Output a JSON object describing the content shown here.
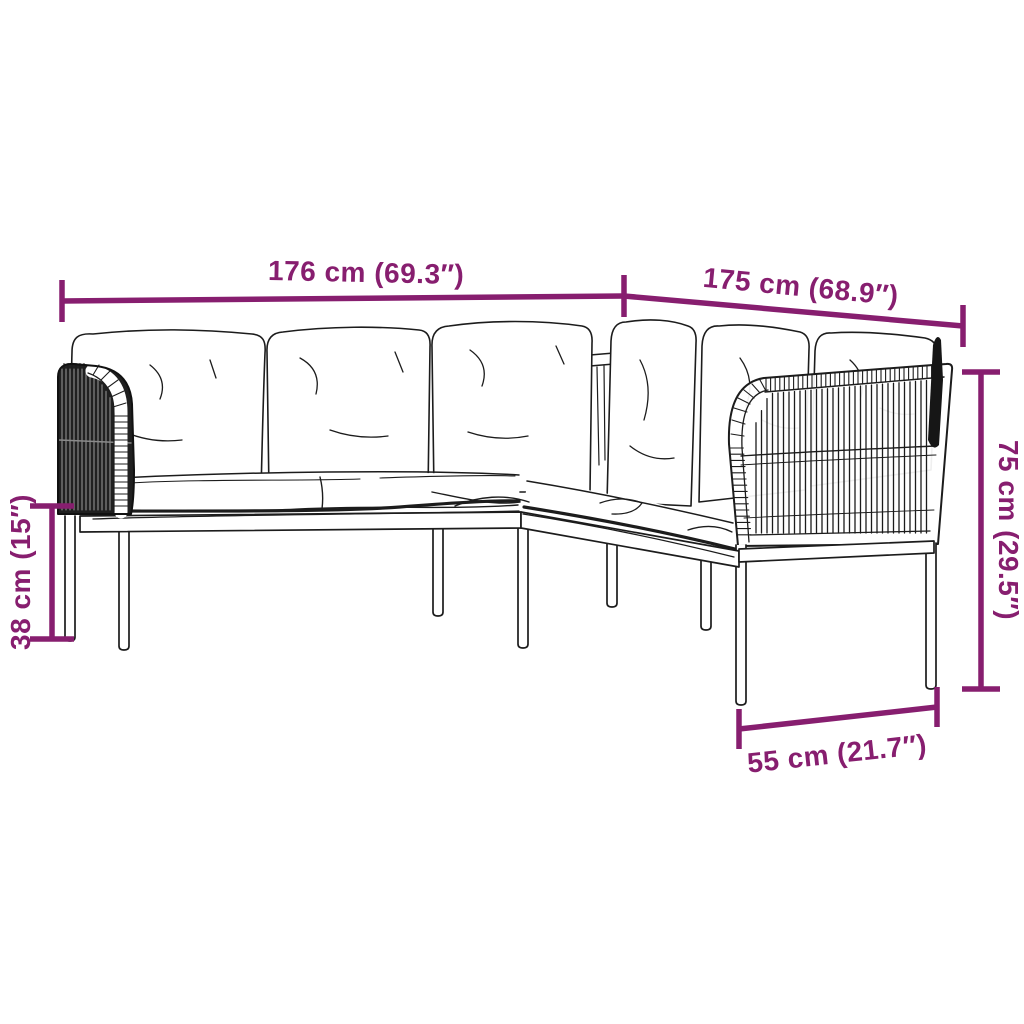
{
  "diagram": {
    "subject": "L-shaped poly-rattan garden corner sofa with cushions — technical dimension drawing",
    "background_color": "#ffffff",
    "accent_color": "#871e6f",
    "line_color": "#1c1c1c",
    "dimensions": {
      "top_left_width": {
        "label": "176 cm (69.3″)"
      },
      "top_right_width": {
        "label": "175 cm (68.9″)"
      },
      "overall_height": {
        "label": "75 cm (29.5″)"
      },
      "seat_height": {
        "label": "38 cm (15″)"
      },
      "seat_depth": {
        "label": "55 cm (21.7″)"
      }
    }
  }
}
